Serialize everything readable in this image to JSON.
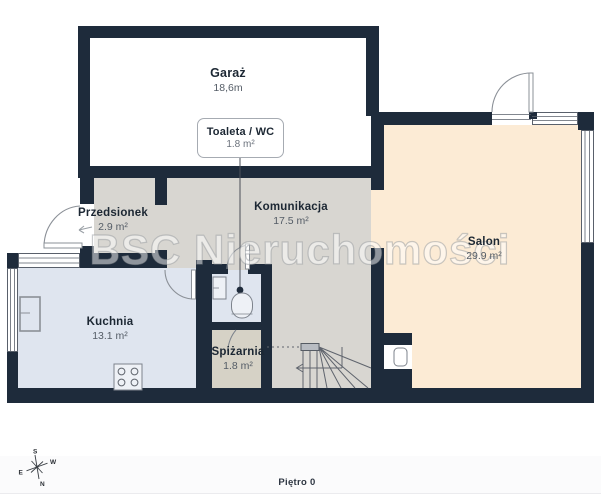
{
  "floorplan": {
    "watermark": "BSC Nieruchomości",
    "footer": {
      "floor_label": "Piętro 0"
    },
    "rooms": {
      "garaz": {
        "name": "Garaż",
        "area": "18,6m"
      },
      "toaleta": {
        "name": "Toaleta / WC",
        "area": "1.8 m²"
      },
      "przedsionek": {
        "name": "Przedsionek",
        "area": "2.9 m²"
      },
      "komunikacja": {
        "name": "Komunikacja",
        "area": "17.5 m²"
      },
      "salon": {
        "name": "Salon",
        "area": "29.9 m²"
      },
      "kuchnia": {
        "name": "Kuchnia",
        "area": "13.1 m²"
      },
      "spizarnia": {
        "name": "Spiżarnia",
        "area": "1.8 m²"
      }
    },
    "compass": {
      "north": "N",
      "south": "S",
      "east": "E",
      "west": "W"
    },
    "colors": {
      "wall": "#1e2b3b",
      "garage_floor": "#ffffff",
      "hall_floor": "#d8d6d1",
      "kitchen_floor": "#dfe5ef",
      "pantry_floor": "#d6d2c6",
      "salon_floor": "#fcebd5"
    }
  }
}
